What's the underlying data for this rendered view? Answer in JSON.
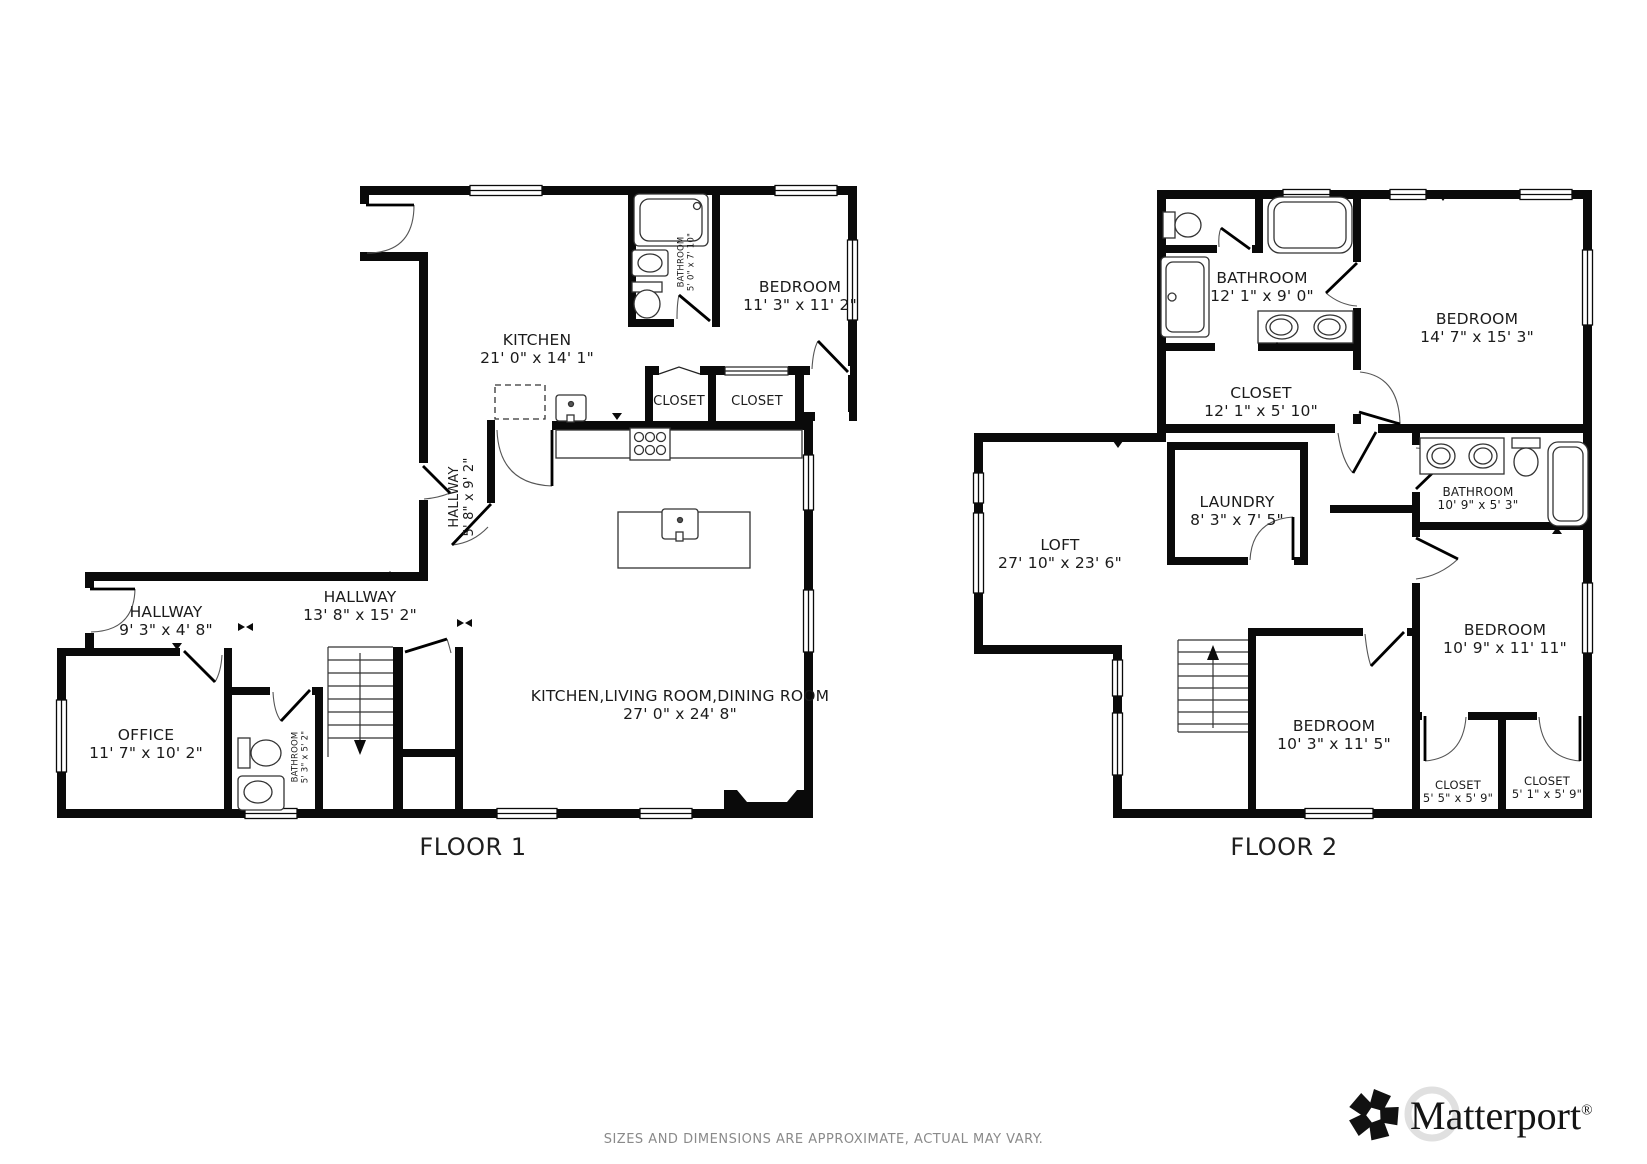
{
  "colors": {
    "wall": "#0a0a0a",
    "label_text": "#1b1b1b",
    "footer_text": "#8a8a8a"
  },
  "floor1": {
    "title": "FLOOR 1",
    "rooms": {
      "kitchen": {
        "name": "KITCHEN",
        "dims": "21' 0\" x 14' 1\""
      },
      "bathroom_top": {
        "name": "BATHROOM",
        "dims": "5' 0\" x 7' 10\""
      },
      "bedroom": {
        "name": "BEDROOM",
        "dims": "11' 3\" x 11' 2\""
      },
      "closet_a": {
        "name": "CLOSET"
      },
      "closet_b": {
        "name": "CLOSET"
      },
      "hallway_upper": {
        "name": "HALLWAY",
        "dims": "5' 8\" x 9' 2\""
      },
      "hallway_left": {
        "name": "HALLWAY",
        "dims": "9' 3\" x 4' 8\""
      },
      "hallway_main": {
        "name": "HALLWAY",
        "dims": "13' 8\" x 15' 2\""
      },
      "office": {
        "name": "OFFICE",
        "dims": "11' 7\" x 10' 2\""
      },
      "bathroom_lower": {
        "name": "BATHROOM",
        "dims": "5' 3\" x 5' 2\""
      },
      "great_room": {
        "name": "KITCHEN,LIVING ROOM,DINING ROOM",
        "dims": "27' 0\" x 24' 8\""
      }
    }
  },
  "floor2": {
    "title": "FLOOR 2",
    "rooms": {
      "bathroom_top": {
        "name": "BATHROOM",
        "dims": "12' 1\" x 9' 0\""
      },
      "bedroom_large": {
        "name": "BEDROOM",
        "dims": "14' 7\" x 15' 3\""
      },
      "closet_large": {
        "name": "CLOSET",
        "dims": "12' 1\" x 5' 10\""
      },
      "laundry": {
        "name": "LAUNDRY",
        "dims": "8' 3\" x 7' 5\""
      },
      "loft": {
        "name": "LOFT",
        "dims": "27' 10\" x 23' 6\""
      },
      "bathroom_small": {
        "name": "BATHROOM",
        "dims": "10' 9\" x 5' 3\""
      },
      "bedroom_right": {
        "name": "BEDROOM",
        "dims": "10' 9\" x 11' 11\""
      },
      "bedroom_bottom": {
        "name": "BEDROOM",
        "dims": "10' 3\" x 11' 5\""
      },
      "closet_a": {
        "name": "CLOSET",
        "dims": "5' 5\" x 5' 9\""
      },
      "closet_b": {
        "name": "CLOSET",
        "dims": "5' 1\" x 5' 9\""
      }
    }
  },
  "footer": {
    "disclaimer": "SIZES AND DIMENSIONS ARE APPROXIMATE, ACTUAL MAY VARY.",
    "brand": "Matterport",
    "registered": "®"
  }
}
